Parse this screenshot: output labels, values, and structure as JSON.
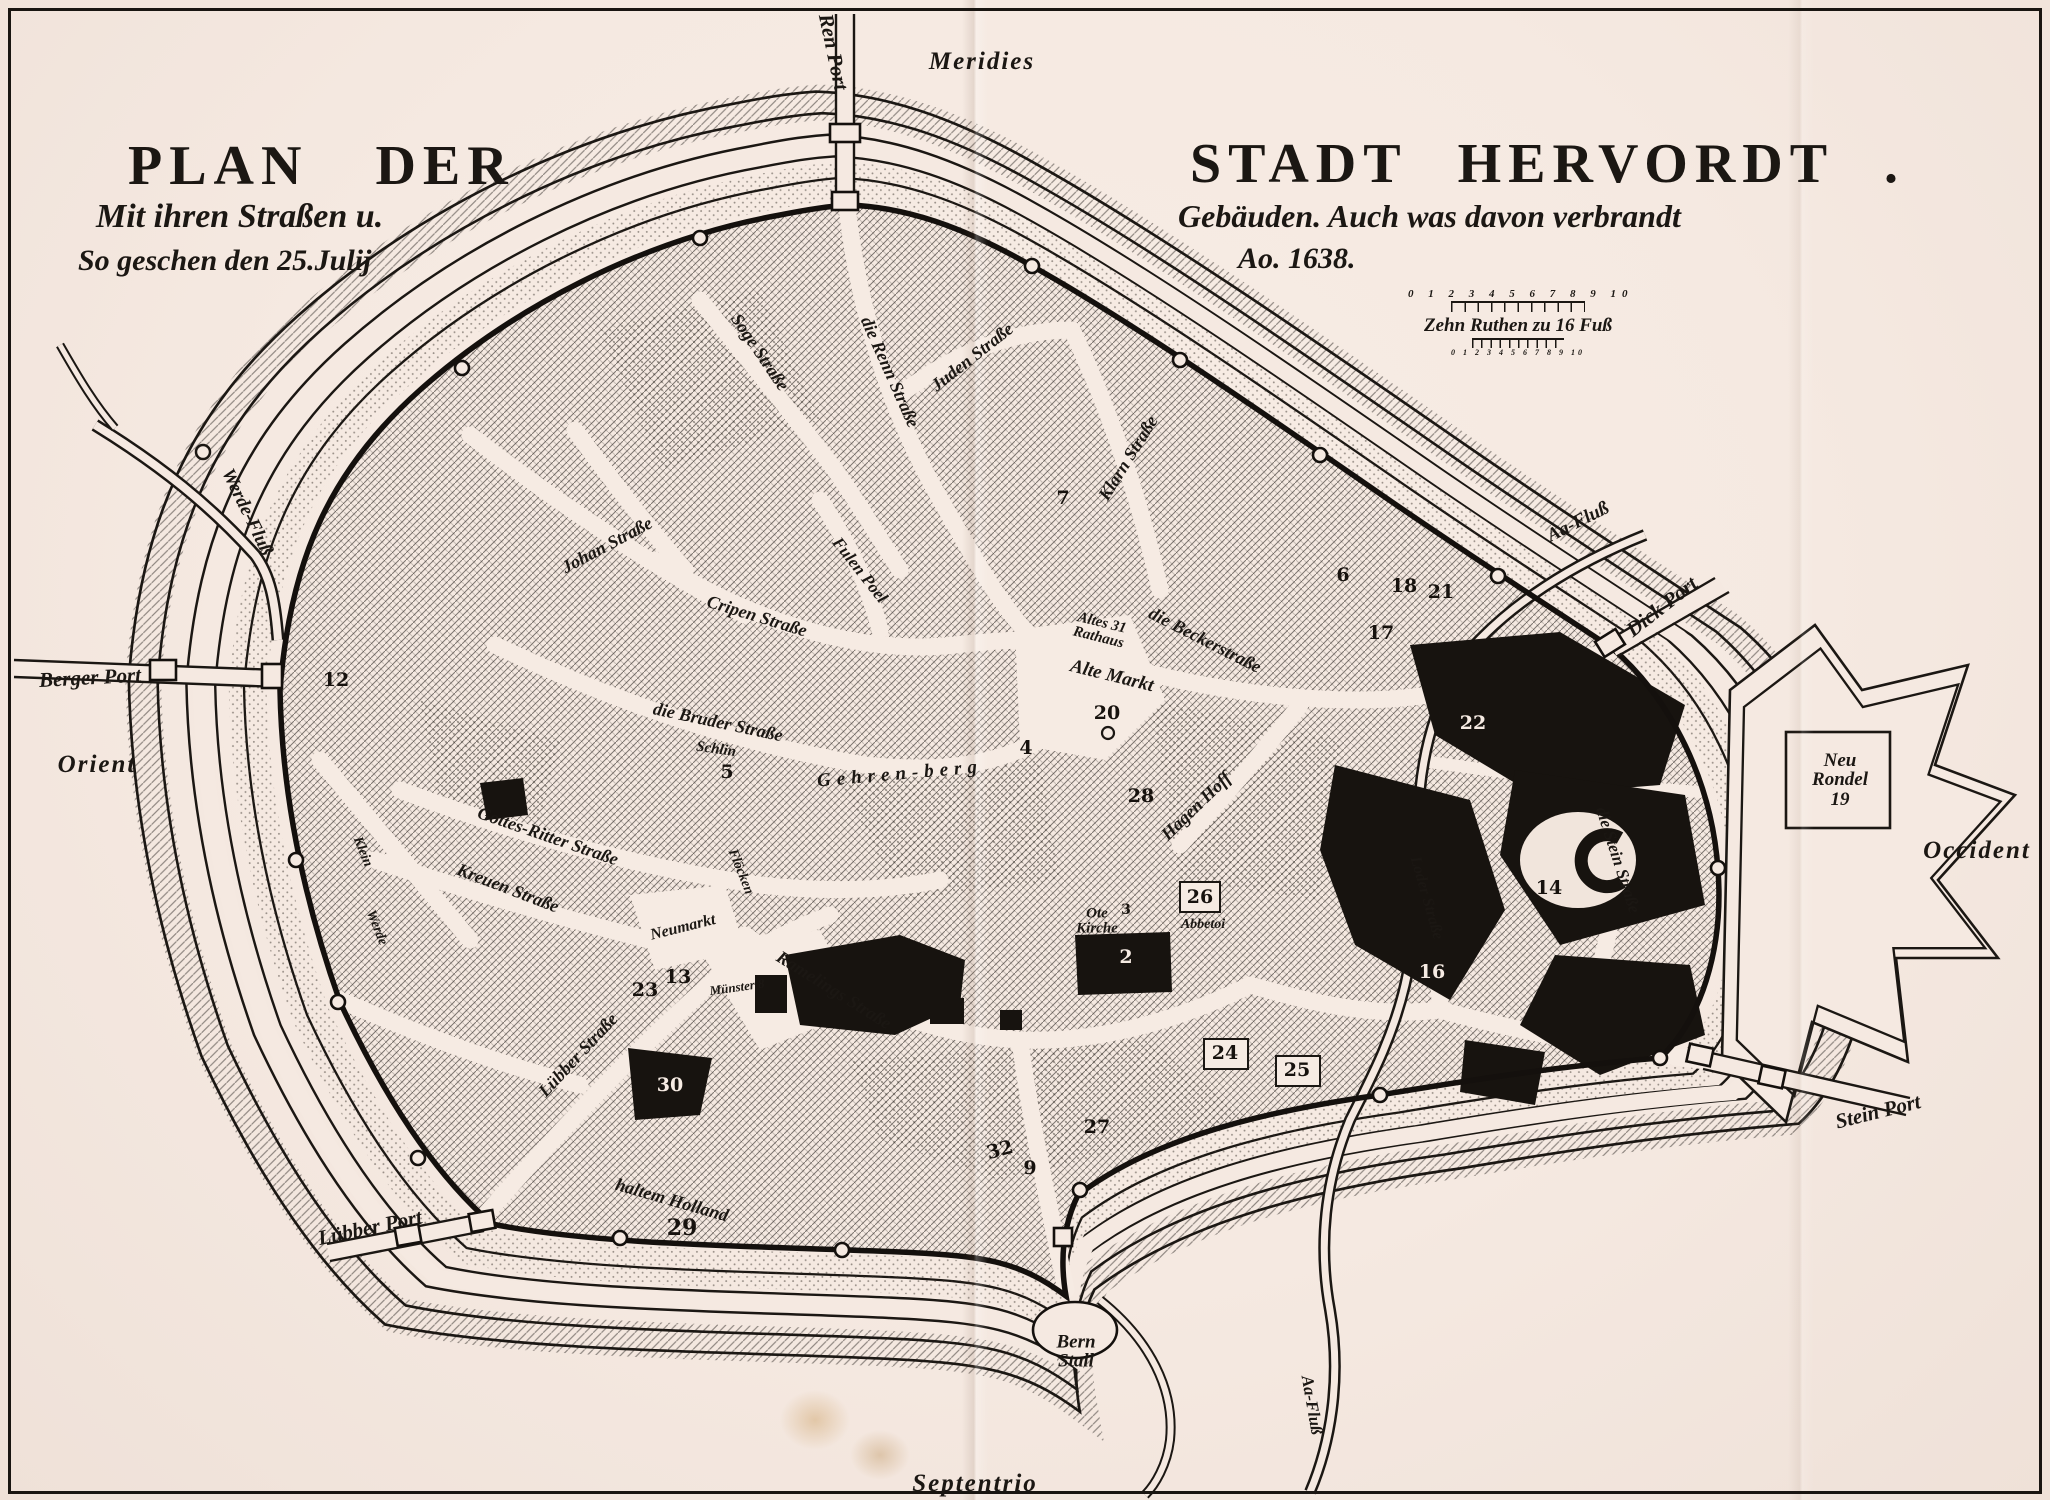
{
  "canvas": {
    "paper_color": "#f5e9e1",
    "ink_color": "#1b1713"
  },
  "title_left": {
    "line1": "PLAN  DER",
    "line2": "Mit ihren Straßen u.",
    "line3": "So geschen   den   25.Julij"
  },
  "title_right": {
    "line1": "STADT  HERVORDT .",
    "line2": "Gebäuden. Auch was davon verbrandt",
    "line3": "Ao. 1638."
  },
  "scale_bar": {
    "numbers_top": "0 1 2 3 4 5 6 7 8 9 10",
    "caption": "Zehn Ruthen zu 16 Fuß",
    "numbers_bottom": "0 1 2 3 4 5 6 7 8 9 10"
  },
  "compass": {
    "top": "Meridies",
    "bottom": "Septentrio",
    "left": "Orient",
    "right": "Occident"
  },
  "map": {
    "labels": [
      {
        "name": "ren-port",
        "text": "Ren Port",
        "x": 833,
        "y": 52,
        "r": 78,
        "s": 21
      },
      {
        "name": "werde-fluss",
        "text": "Werde-Fluß",
        "x": 247,
        "y": 512,
        "r": 64,
        "s": 19
      },
      {
        "name": "berger-port",
        "text": "Berger Port",
        "x": 90,
        "y": 678,
        "r": -3,
        "s": 21
      },
      {
        "name": "luebber-port",
        "text": "Lübber Port",
        "x": 370,
        "y": 1228,
        "r": -12,
        "s": 21
      },
      {
        "name": "bern-stall",
        "text": "Bern\nStall",
        "x": 1076,
        "y": 1352,
        "r": 0,
        "s": 19
      },
      {
        "name": "aa-fluss-bottom",
        "text": "Aa-Fluß",
        "x": 1312,
        "y": 1405,
        "r": 80,
        "s": 17
      },
      {
        "name": "aa-fluss-right",
        "text": "Aa-Fluß",
        "x": 1578,
        "y": 522,
        "r": -27,
        "s": 19
      },
      {
        "name": "dick-port",
        "text": "Dick Port",
        "x": 1662,
        "y": 607,
        "r": -38,
        "s": 21
      },
      {
        "name": "neu-rondel",
        "text": "Neu\nRondel\n19",
        "x": 1840,
        "y": 780,
        "r": 0,
        "s": 19
      },
      {
        "name": "stein-port",
        "text": "Stein Port",
        "x": 1878,
        "y": 1112,
        "r": -14,
        "s": 21
      },
      {
        "name": "soge-strasse",
        "text": "Soge Straße",
        "x": 760,
        "y": 352,
        "r": 56,
        "s": 18
      },
      {
        "name": "renn-strasse",
        "text": "die Renn Straße",
        "x": 890,
        "y": 372,
        "r": 66,
        "s": 18
      },
      {
        "name": "juden-strasse",
        "text": "Juden Straße",
        "x": 972,
        "y": 357,
        "r": -38,
        "s": 18
      },
      {
        "name": "klarn-strasse",
        "text": "Klarn Straße",
        "x": 1128,
        "y": 458,
        "r": -58,
        "s": 18
      },
      {
        "name": "johan-strasse",
        "text": "Johan Straße",
        "x": 607,
        "y": 545,
        "r": -28,
        "s": 18
      },
      {
        "name": "cripen-strasse",
        "text": "Cripen Straße",
        "x": 757,
        "y": 616,
        "r": 17,
        "s": 18
      },
      {
        "name": "fulen-poel",
        "text": "Fulen Poel",
        "x": 860,
        "y": 570,
        "r": 52,
        "s": 17
      },
      {
        "name": "bruder-strasse",
        "text": "die Bruder Straße",
        "x": 718,
        "y": 722,
        "r": 12,
        "s": 18
      },
      {
        "name": "schlin",
        "text": "Schlin",
        "x": 716,
        "y": 750,
        "r": 8,
        "s": 15
      },
      {
        "name": "gehren-berg",
        "text": "Gehren-berg",
        "x": 900,
        "y": 774,
        "r": -5,
        "s": 19,
        "cls": "spaced"
      },
      {
        "name": "altes-rathaus",
        "text": "Altes 31\nRathaus",
        "x": 1100,
        "y": 631,
        "r": 14,
        "s": 15
      },
      {
        "name": "alte-markt",
        "text": "Alte Markt",
        "x": 1112,
        "y": 676,
        "r": 14,
        "s": 19
      },
      {
        "name": "becker-strasse",
        "text": "die Beckerstraße",
        "x": 1205,
        "y": 640,
        "r": 27,
        "s": 18
      },
      {
        "name": "hagen-hoff",
        "text": "Hagen Hoff",
        "x": 1196,
        "y": 806,
        "r": -44,
        "s": 18
      },
      {
        "name": "ote-kirche",
        "text": "Ote\nKirche",
        "x": 1097,
        "y": 922,
        "r": 0,
        "s": 15
      },
      {
        "name": "abbetoi",
        "text": "Abbetoi",
        "x": 1203,
        "y": 925,
        "r": 0,
        "s": 14
      },
      {
        "name": "stein-strasse",
        "text": "die Stein Straße",
        "x": 1618,
        "y": 860,
        "r": 72,
        "s": 17
      },
      {
        "name": "loder-strasse",
        "text": "Loder Straße",
        "x": 1426,
        "y": 898,
        "r": 74,
        "s": 16
      },
      {
        "name": "gottes-ritter-strasse",
        "text": "Gottes-Ritter Straße",
        "x": 548,
        "y": 836,
        "r": 19,
        "s": 18
      },
      {
        "name": "kreuen-strasse",
        "text": "Kreuen Straße",
        "x": 508,
        "y": 888,
        "r": 21,
        "s": 18
      },
      {
        "name": "klein",
        "text": "Klein",
        "x": 362,
        "y": 852,
        "r": 68,
        "s": 14
      },
      {
        "name": "werde",
        "text": "Werde",
        "x": 376,
        "y": 928,
        "r": 68,
        "s": 14
      },
      {
        "name": "luebber-strasse",
        "text": "Lübber Straße",
        "x": 578,
        "y": 1055,
        "r": -47,
        "s": 18
      },
      {
        "name": "haltem-holland",
        "text": "haltem Holland",
        "x": 672,
        "y": 1200,
        "r": 16,
        "s": 18
      },
      {
        "name": "neumarkt",
        "text": "Neumarkt",
        "x": 683,
        "y": 928,
        "r": -14,
        "s": 16
      },
      {
        "name": "floecken",
        "text": "Flöcken",
        "x": 740,
        "y": 872,
        "r": 68,
        "s": 14
      },
      {
        "name": "ramelings-strasse",
        "text": "Ramelings Straße",
        "x": 834,
        "y": 990,
        "r": 32,
        "s": 18
      },
      {
        "name": "muenster",
        "text": "Münster 8",
        "x": 737,
        "y": 987,
        "r": -8,
        "s": 13
      }
    ],
    "numbers": [
      {
        "t": "20",
        "x": 1107,
        "y": 713
      },
      {
        "t": "4",
        "x": 1026,
        "y": 748
      },
      {
        "t": "5",
        "x": 727,
        "y": 772
      },
      {
        "t": "6",
        "x": 1343,
        "y": 575
      },
      {
        "t": "7",
        "x": 1063,
        "y": 498
      },
      {
        "t": "17",
        "x": 1381,
        "y": 633
      },
      {
        "t": "18",
        "x": 1404,
        "y": 586
      },
      {
        "t": "21",
        "x": 1441,
        "y": 592
      },
      {
        "t": "22",
        "x": 1473,
        "y": 723,
        "inv": true
      },
      {
        "t": "14",
        "x": 1549,
        "y": 888
      },
      {
        "t": "16",
        "x": 1432,
        "y": 972,
        "inv": true
      },
      {
        "t": "26",
        "x": 1200,
        "y": 897
      },
      {
        "t": "28",
        "x": 1141,
        "y": 796
      },
      {
        "t": "24",
        "x": 1225,
        "y": 1053
      },
      {
        "t": "25",
        "x": 1297,
        "y": 1070
      },
      {
        "t": "27",
        "x": 1097,
        "y": 1127
      },
      {
        "t": "32",
        "x": 1000,
        "y": 1150,
        "r": -15
      },
      {
        "t": "9",
        "x": 1030,
        "y": 1168
      },
      {
        "t": "2",
        "x": 1126,
        "y": 957,
        "inv": true
      },
      {
        "t": "30",
        "x": 670,
        "y": 1085,
        "inv": true
      },
      {
        "t": "29",
        "x": 682,
        "y": 1228,
        "s": 22
      },
      {
        "t": "23",
        "x": 645,
        "y": 990
      },
      {
        "t": "13",
        "x": 678,
        "y": 977
      },
      {
        "t": "12",
        "x": 336,
        "y": 680
      },
      {
        "t": "3",
        "x": 1126,
        "y": 910,
        "s": 14
      }
    ]
  }
}
